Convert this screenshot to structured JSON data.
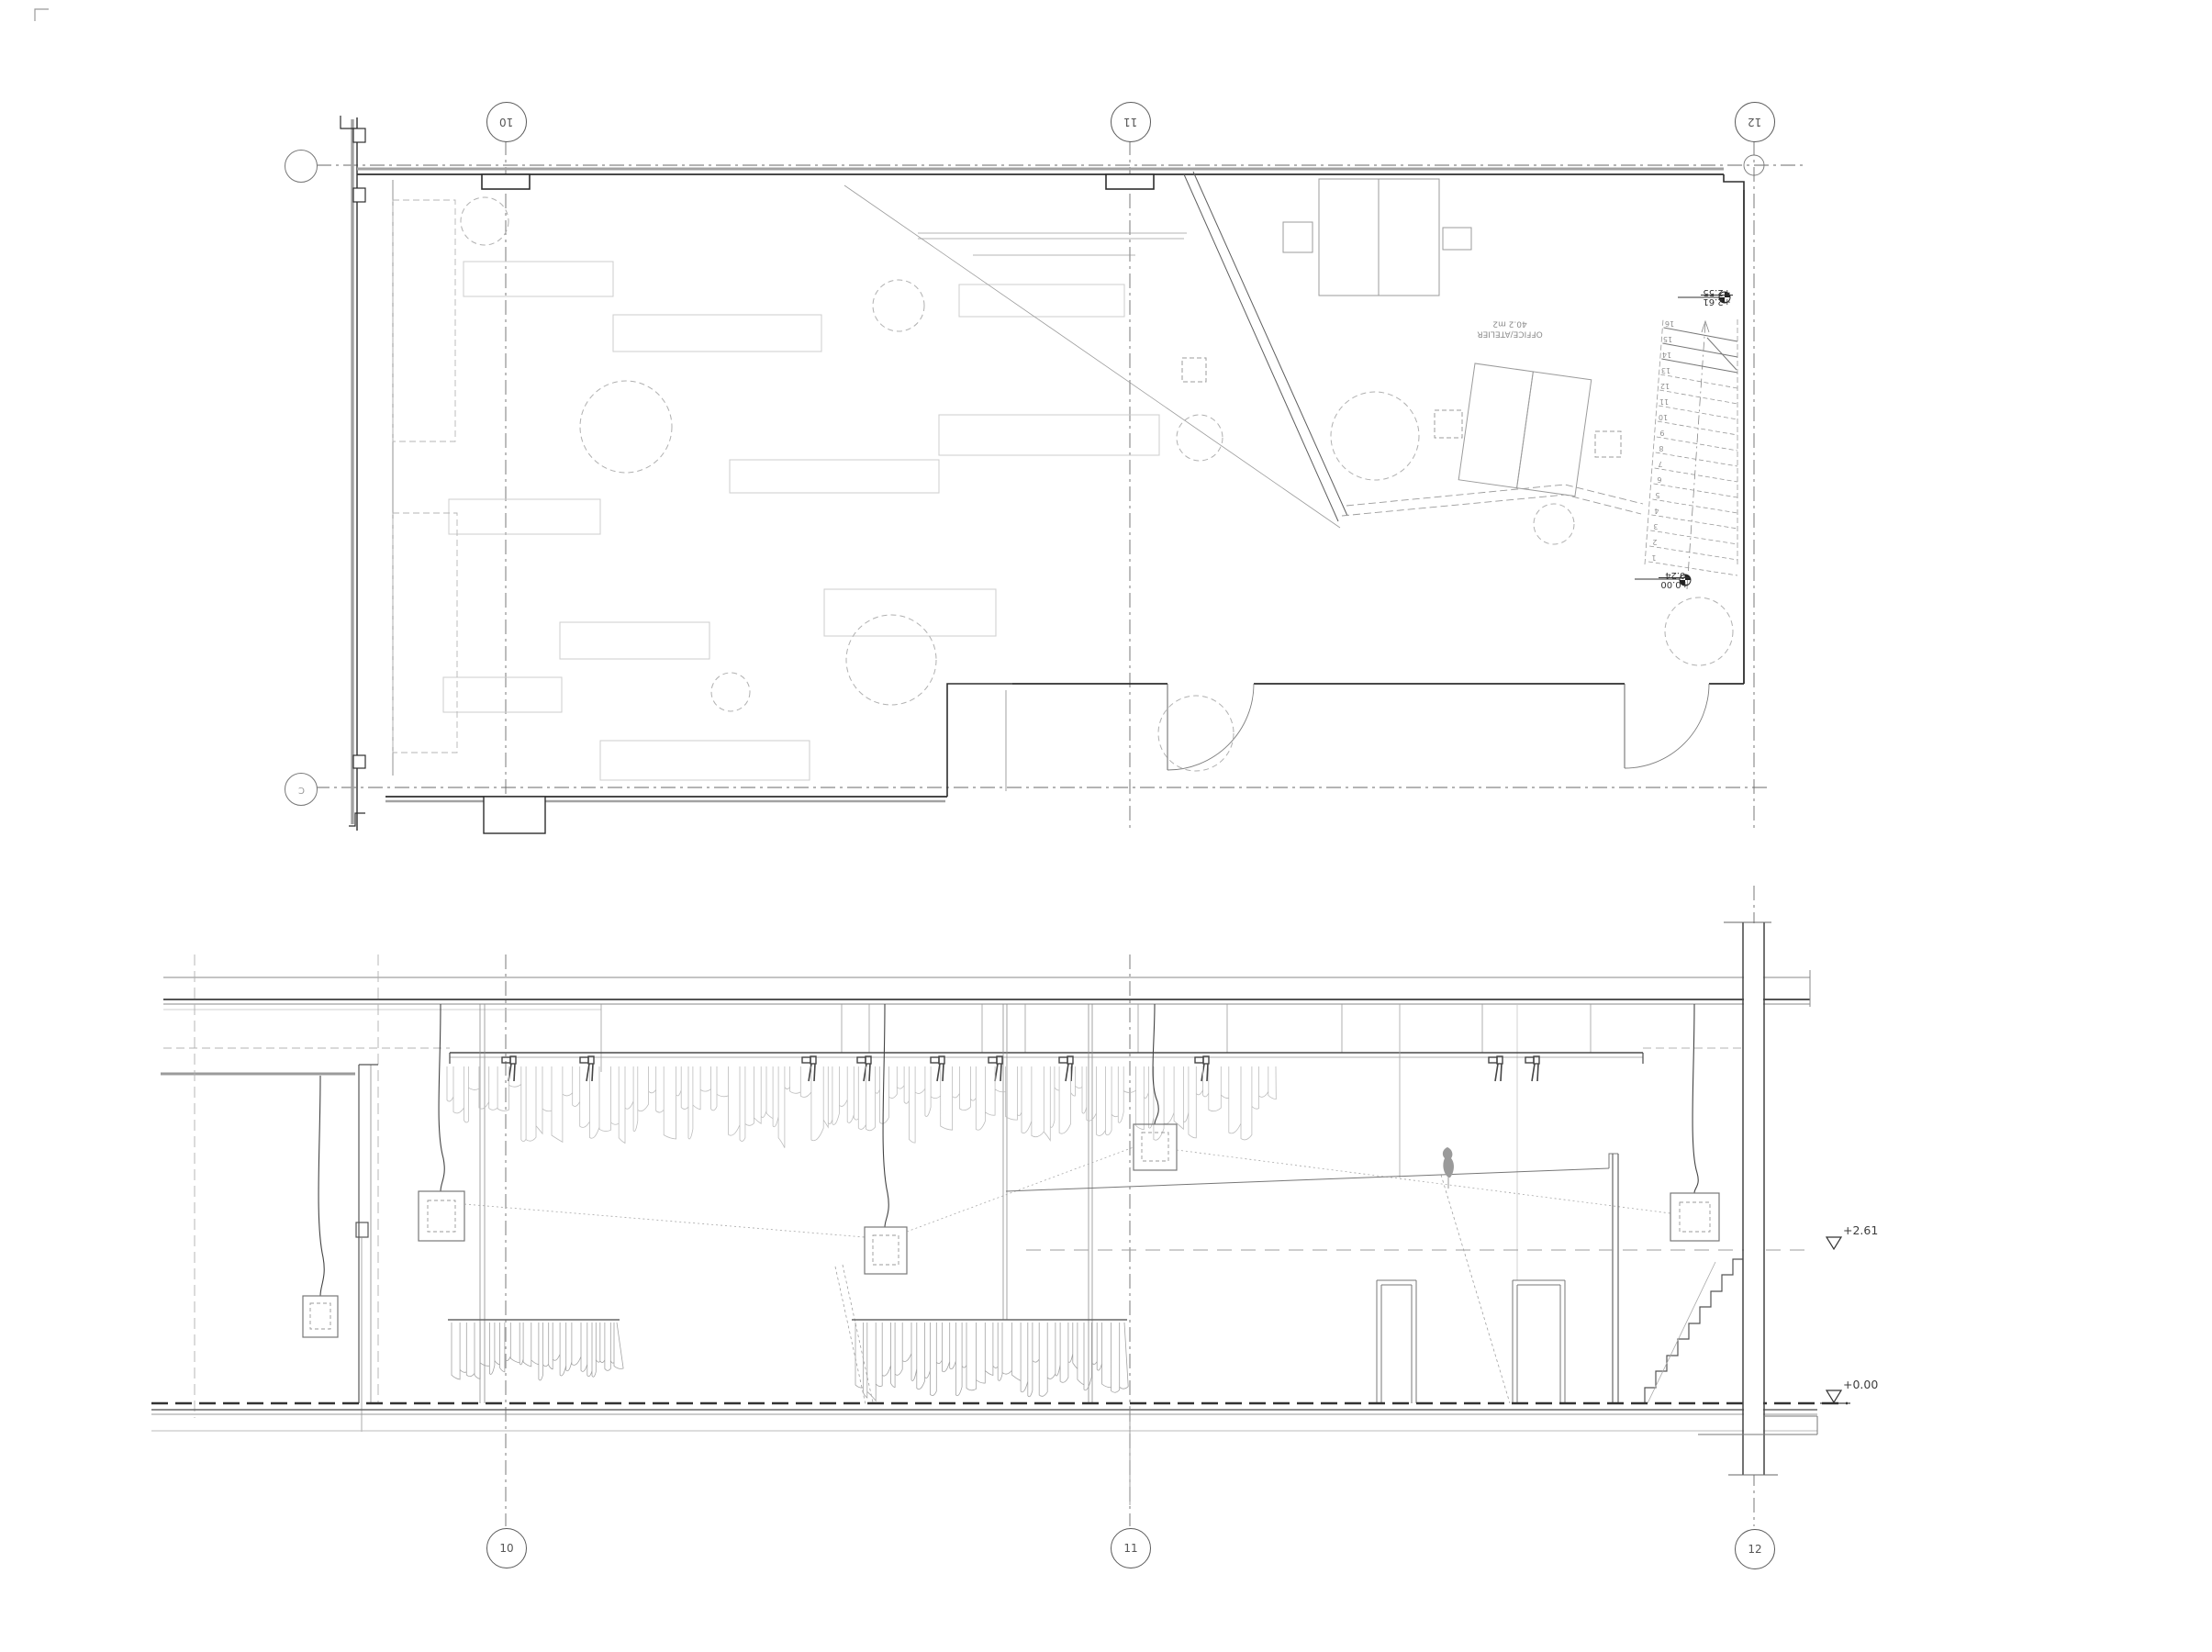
{
  "sheet": {
    "title": "floor-plan-and-section-drawing",
    "background": "#ffffff",
    "line_color": "#3f3f3f",
    "faint_color": "#c8c8c8"
  },
  "plan": {
    "grid_bubbles_top": [
      {
        "label": "10"
      },
      {
        "label": "11"
      },
      {
        "label": "12"
      }
    ],
    "row_bubbles": {
      "top_label": "",
      "bottom_label": "C"
    },
    "room": {
      "name": "OFFICE/ATELIER",
      "area": "40.2 m2"
    },
    "stair": {
      "tread_numbers": [
        "1",
        "2",
        "3",
        "4",
        "5",
        "6",
        "7",
        "8",
        "9",
        "10",
        "11",
        "12",
        "13",
        "14",
        "15",
        "16"
      ],
      "upper_level": {
        "primary": "+2.61",
        "secondary": "+2.55"
      },
      "lower_level": {
        "primary": "+0.00",
        "secondary": "-0.24"
      }
    }
  },
  "section": {
    "grid_bubbles_bottom": [
      {
        "label": "10"
      },
      {
        "label": "11"
      },
      {
        "label": "12"
      }
    ],
    "levels": [
      {
        "label": "+2.61"
      },
      {
        "label": "+0.00"
      }
    ]
  }
}
